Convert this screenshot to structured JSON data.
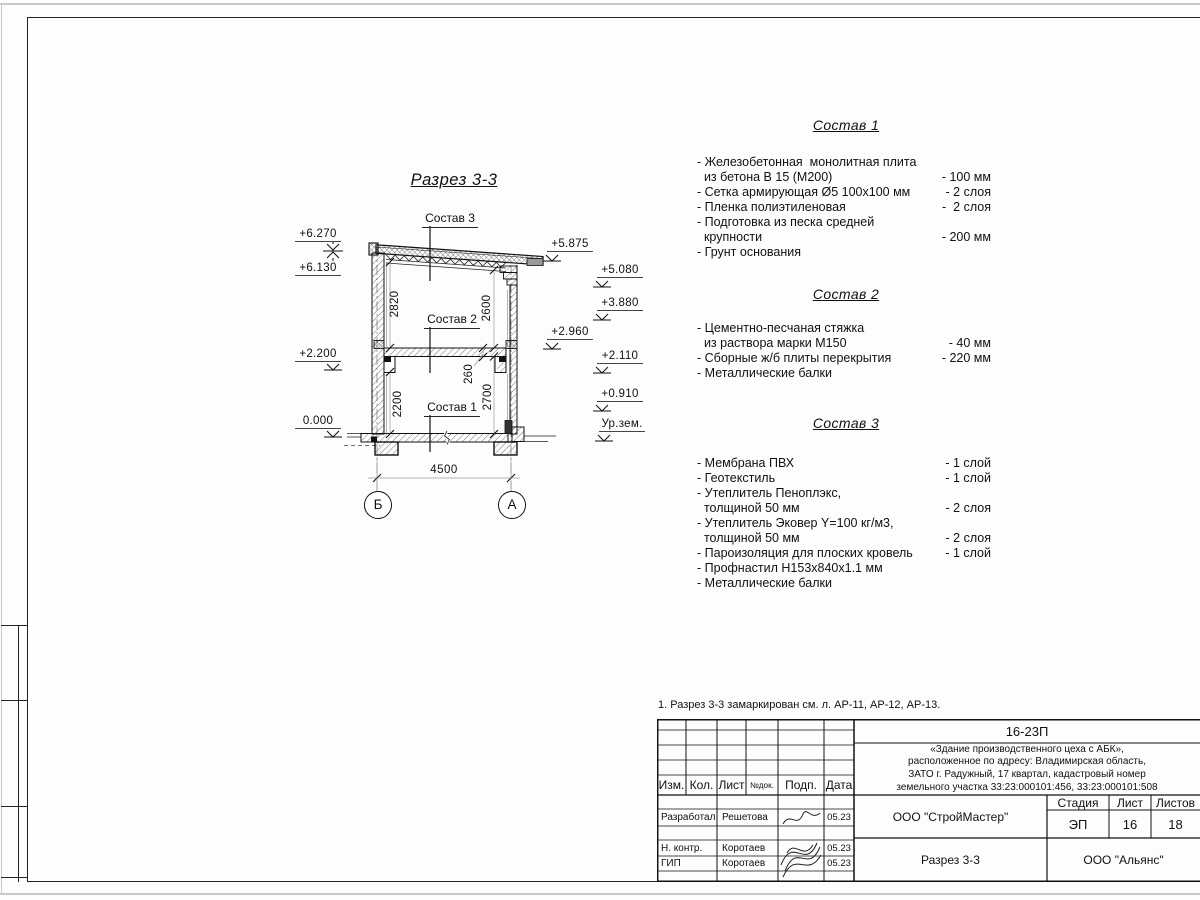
{
  "sheet": {
    "note": "1. Разрез 3-3 замаркирован см. л. АР-11, АР-12, АР-13."
  },
  "drawing": {
    "title": "Разрез 3-3",
    "labels": {
      "sostav1": "Состав 1",
      "sostav2": "Состав 2",
      "sostav3": "Состав 3"
    },
    "dims": {
      "d2820": "2820",
      "d2600": "2600",
      "d2200": "2200",
      "d260": "260",
      "d2700": "2700",
      "d4500": "4500"
    },
    "axes": {
      "left": "Б",
      "right": "А"
    },
    "elev": {
      "e6270": "+6.270",
      "e6130": "+6.130",
      "e2200": "+2.200",
      "e0000": "0.000",
      "e5875": "+5.875",
      "e5080": "+5.080",
      "e3880": "+3.880",
      "e2960": "+2.960",
      "e2110": "+2.110",
      "e0910": "+0.910",
      "ground": "Ур.зем."
    }
  },
  "specs": [
    {
      "title": "Состав 1",
      "rows": [
        {
          "t": "- Железобетонная  монолитная плита",
          "v": ""
        },
        {
          "t": "  из бетона В 15 (М200)",
          "v": "- 100 мм"
        },
        {
          "t": "- Сетка армирующая Ø5 100х100 мм",
          "v": "- 2 слоя"
        },
        {
          "t": "- Пленка полиэтиленовая",
          "v": "-  2 слоя"
        },
        {
          "t": "- Подготовка из песка средней",
          "v": ""
        },
        {
          "t": "  крупности",
          "v": "- 200 мм"
        },
        {
          "t": "- Грунт основания",
          "v": ""
        }
      ]
    },
    {
      "title": "Состав 2",
      "rows": [
        {
          "t": "- Цементно-песчаная стяжка",
          "v": ""
        },
        {
          "t": "  из раствора марки М150",
          "v": "- 40 мм"
        },
        {
          "t": "- Сборные ж/б плиты перекрытия",
          "v": "- 220 мм"
        },
        {
          "t": "- Металлические балки",
          "v": ""
        }
      ]
    },
    {
      "title": "Состав 3",
      "rows": [
        {
          "t": "- Мембрана ПВХ",
          "v": "- 1 слой"
        },
        {
          "t": "- Геотекстиль",
          "v": "- 1 слой"
        },
        {
          "t": "- Утеплитель Пеноплэкс,",
          "v": ""
        },
        {
          "t": "  толщиной 50 мм",
          "v": "- 2 слоя"
        },
        {
          "t": "- Утеплитель Эковер Y=100 кг/м3,",
          "v": ""
        },
        {
          "t": "  толщиной 50 мм",
          "v": "- 2 слоя"
        },
        {
          "t": "- Пароизоляция для плоских кровель",
          "v": "- 1 слой"
        },
        {
          "t": "- Профнастил Н153х840х1.1 мм",
          "v": ""
        },
        {
          "t": "- Металлические балки",
          "v": ""
        }
      ]
    }
  ],
  "titleblock": {
    "code": "16-23П",
    "desc_lines": [
      "«Здание производственного цеха с АБК»,",
      "расположенное по адресу: Владимирская область,",
      "ЗАТО г. Радужный, 17 квартал, кадастровый номер",
      "земельного участка 33:23:000101:456, 33:23:000101:508"
    ],
    "cols": {
      "izm": "Изм.",
      "kol": "Кол.",
      "list": "Лист",
      "ndok": "№док.",
      "podp": "Подп.",
      "data": "Дата"
    },
    "stage_label": "Стадия",
    "sheet_label": "Лист",
    "sheets_label": "Листов",
    "stage": "ЭП",
    "sheet_no": "16",
    "sheets_total": "18",
    "org": "ООО \"СтройМастер\"",
    "doc_title": "Разрез 3-3",
    "customer": "ООО \"Альянс\"",
    "roles": [
      {
        "role": "Разработал",
        "name": "Решетова",
        "date": "05.23"
      },
      {
        "role": "Н. контр.",
        "name": "Коротаев",
        "date": "05.23"
      },
      {
        "role": "ГИП",
        "name": "Коротаев",
        "date": "05.23"
      }
    ]
  }
}
